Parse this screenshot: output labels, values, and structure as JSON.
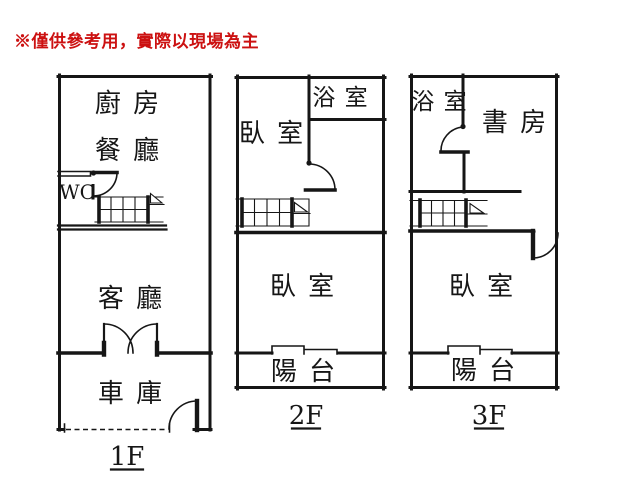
{
  "disclaimer": "※僅供參考用，實際以現場為主",
  "colors": {
    "background": "#ffffff",
    "line": "#161616",
    "accent_red": "#cc1111"
  },
  "floors": [
    {
      "name": "1F",
      "rooms": {
        "kitchen": "廚 房",
        "dining": "餐 廳",
        "wc": "WC",
        "living": "客 廳",
        "garage": "車 庫"
      }
    },
    {
      "name": "2F",
      "rooms": {
        "bedroom_front": "臥 室",
        "bath": "浴 室",
        "bedroom_main": "臥 室",
        "balcony": "陽 台"
      }
    },
    {
      "name": "3F",
      "rooms": {
        "bath": "浴 室",
        "study": "書 房",
        "bedroom_main": "臥 室",
        "balcony": "陽 台"
      }
    }
  ]
}
